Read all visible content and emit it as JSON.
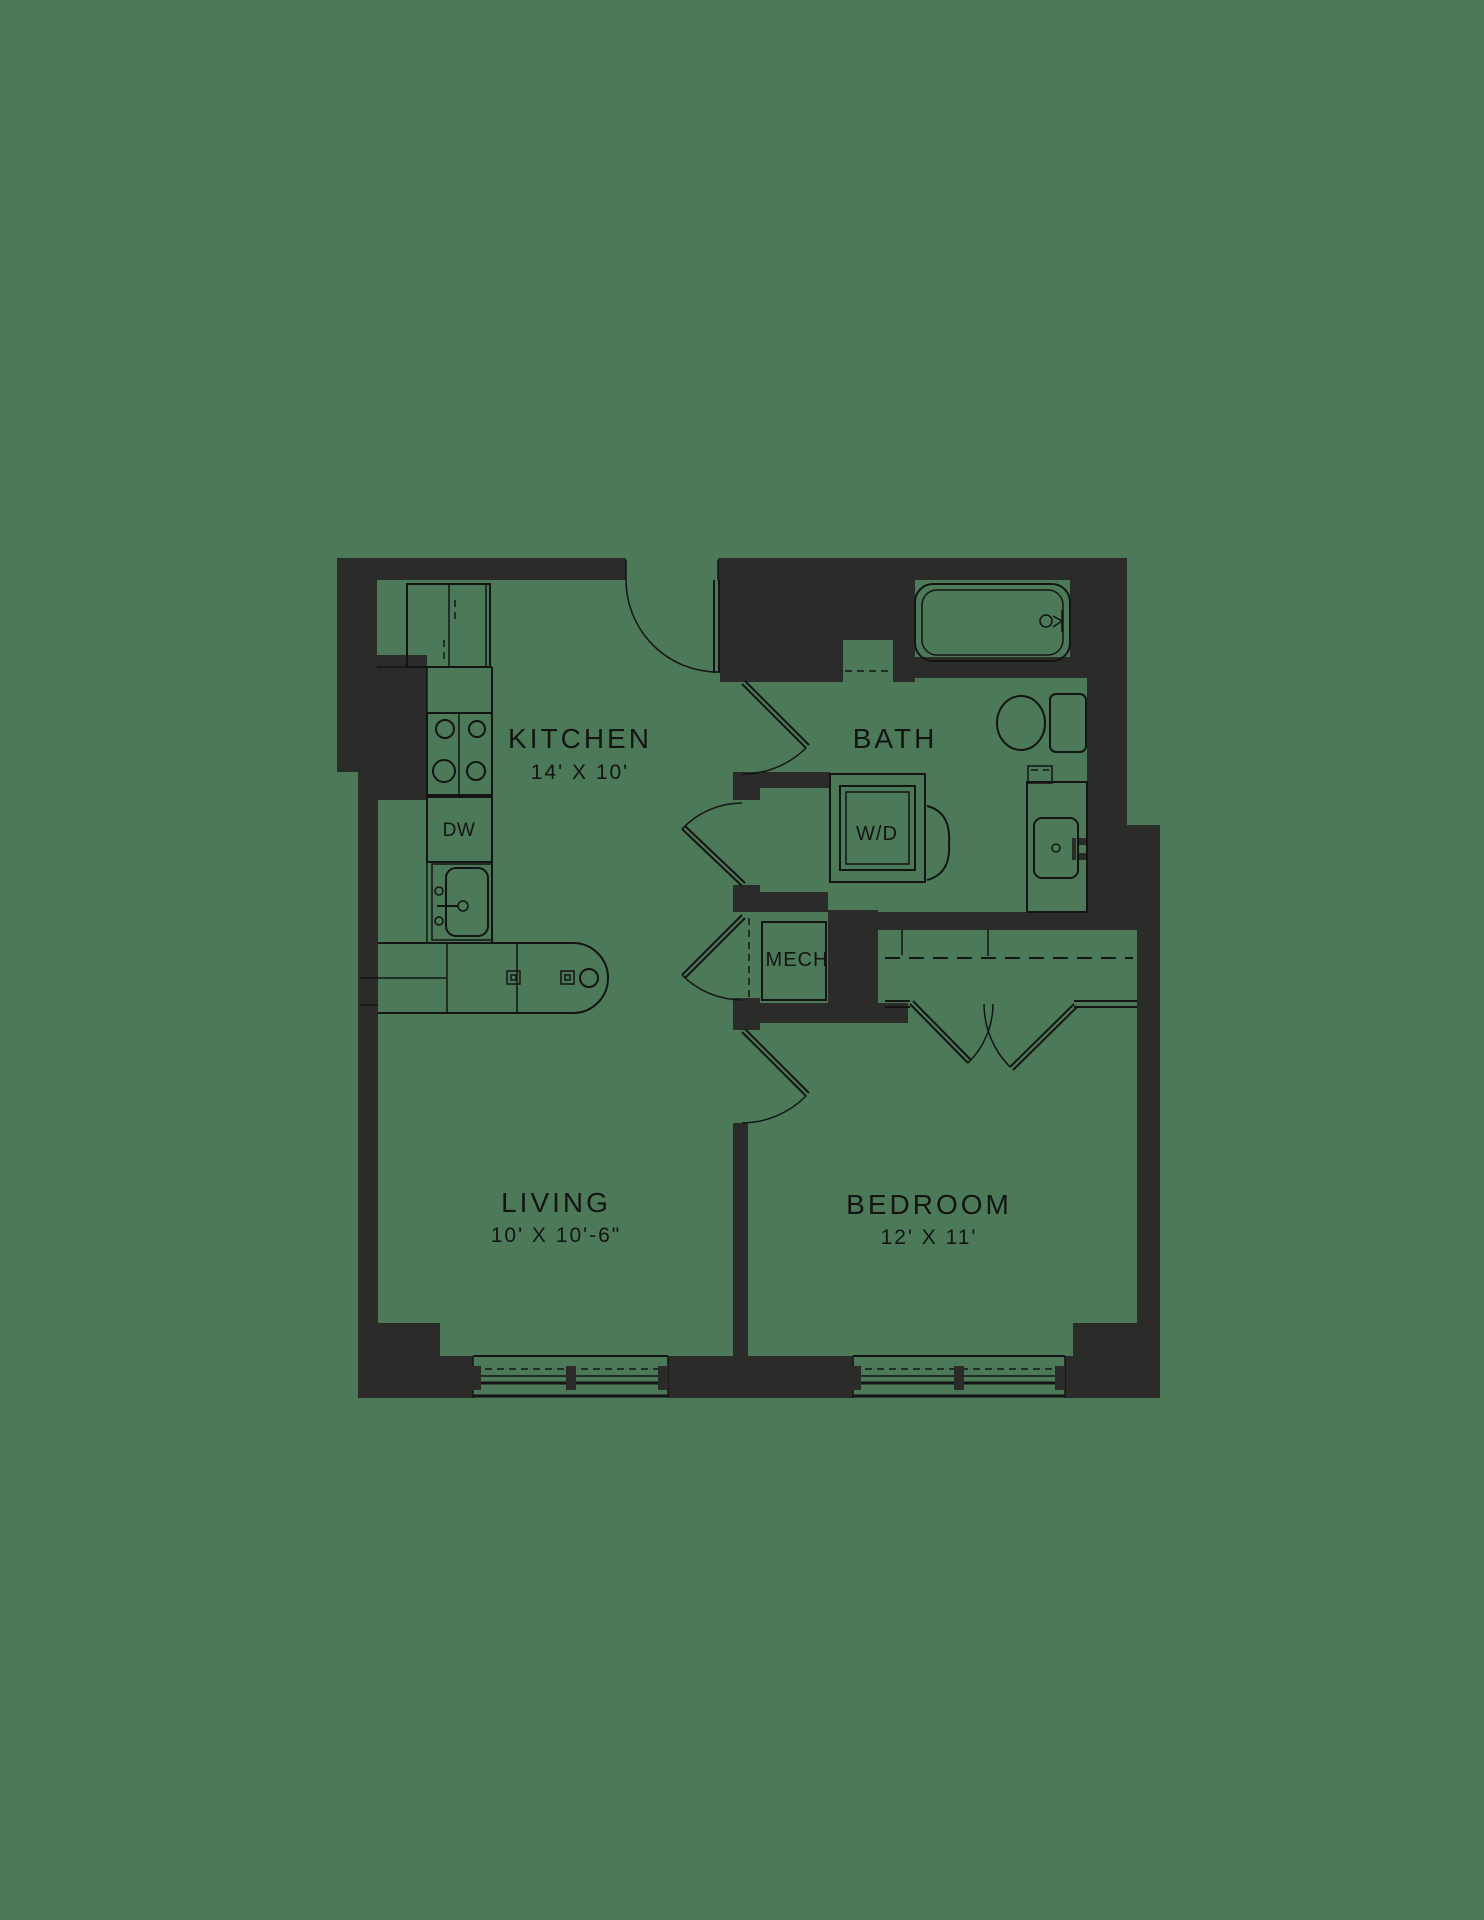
{
  "floorplan": {
    "colors": {
      "background": "#4C7A59",
      "wall": "#2B2C2A",
      "line": "#141414"
    },
    "rooms": {
      "kitchen": {
        "label": "KITCHEN",
        "dimensions": "14' X 10'"
      },
      "bath": {
        "label": "BATH"
      },
      "living": {
        "label": "LIVING",
        "dimensions": "10' X 10'-6\""
      },
      "bedroom": {
        "label": "BEDROOM",
        "dimensions": "12' X 11'"
      },
      "mech": {
        "label": "MECH"
      }
    },
    "appliances": {
      "washer_dryer": {
        "label": "W/D"
      },
      "dishwasher": {
        "label": "DW"
      }
    },
    "fixtures": [
      "refrigerator",
      "range-4-burner",
      "dishwasher",
      "kitchen-sink",
      "island-counter",
      "bathtub",
      "toilet",
      "vanity-sink",
      "washer-dryer",
      "closet-rod",
      "window",
      "door-swing"
    ]
  }
}
